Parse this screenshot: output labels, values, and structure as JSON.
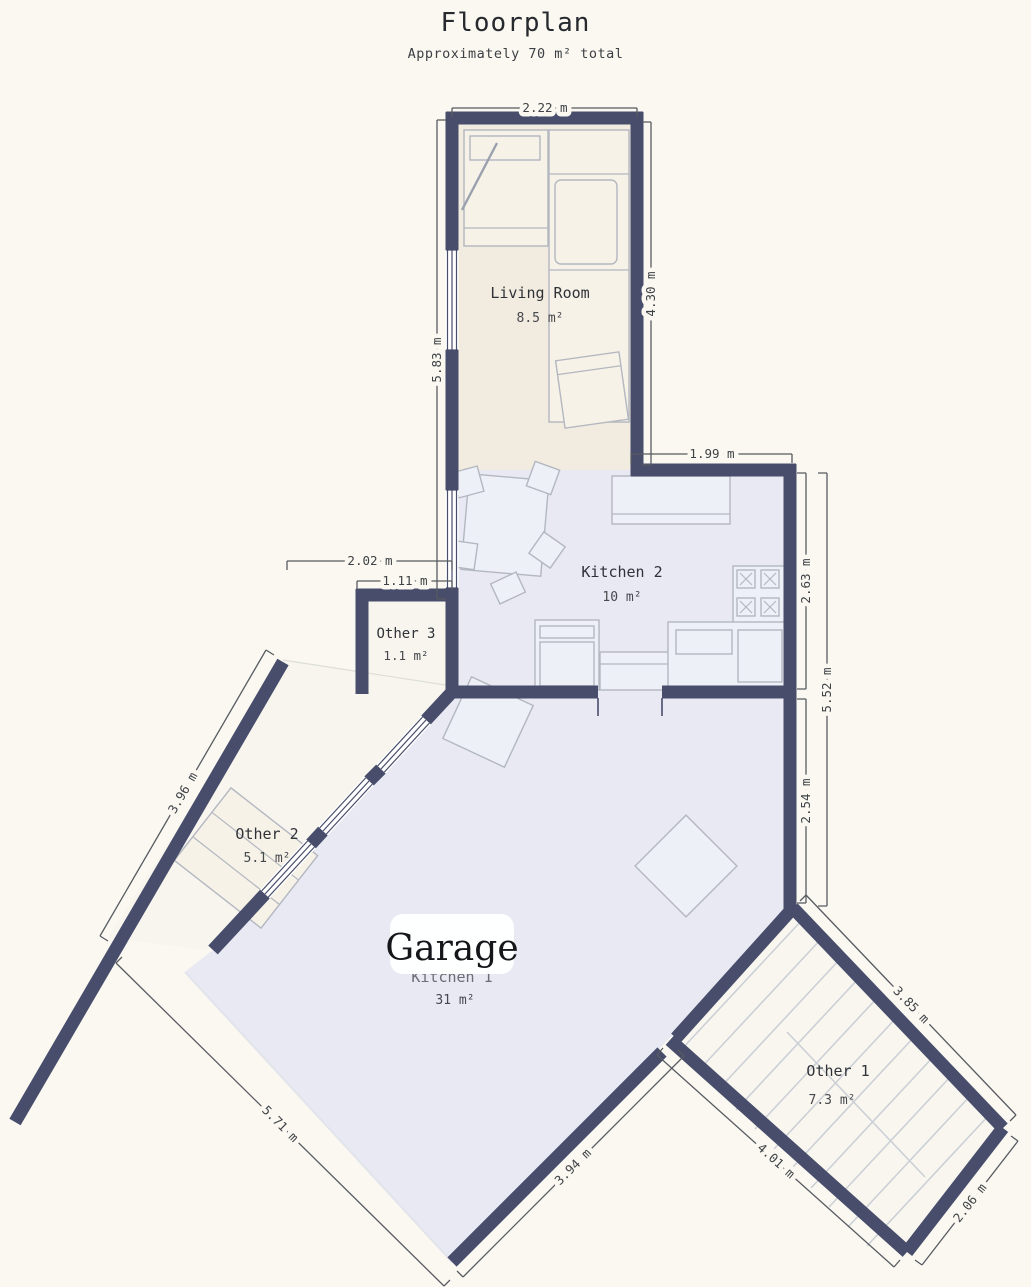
{
  "title": "Floorplan",
  "subtitle": "Approximately 70 m² total",
  "rooms": {
    "living_room": {
      "name": "Living Room",
      "area": "8.5 m²"
    },
    "kitchen2": {
      "name": "Kitchen 2",
      "area": "10 m²"
    },
    "other3": {
      "name": "Other 3",
      "area": "1.1 m²"
    },
    "other2": {
      "name": "Other 2",
      "area": "5.1 m²"
    },
    "kitchen1": {
      "name": "Kitchen 1",
      "area": "31 m²"
    },
    "other1": {
      "name": "Other 1",
      "area": "7.3 m²"
    }
  },
  "overlay_label": "Garage",
  "dimensions": {
    "living_top": "2.22 m",
    "living_right": "4.30 m",
    "living_left": "5.83 m",
    "kitchen_top": "1.99 m",
    "kitchen_right": "2.63 m",
    "right_total": "5.52 m",
    "right_lower": "2.54 m",
    "other3_width_outer": "2.02 m",
    "other3_width_inner": "1.11 m",
    "other2_wall": "3.96 m",
    "garage_left": "5.71 m",
    "garage_bottom": "3.94 m",
    "other1_top_right": "3.85 m",
    "other1_bottom_left": "4.01 m",
    "other1_bottom_right": "2.06 m"
  },
  "colors": {
    "background": "#faf8f1",
    "wall": "#474d6a",
    "living_fill": "#f2ebdf",
    "kitchen_fill": "#e8e9f2",
    "room_fill": "#f7f5ee",
    "dimension_text": "#3f4347",
    "furniture_line": "#b3b7c0"
  }
}
